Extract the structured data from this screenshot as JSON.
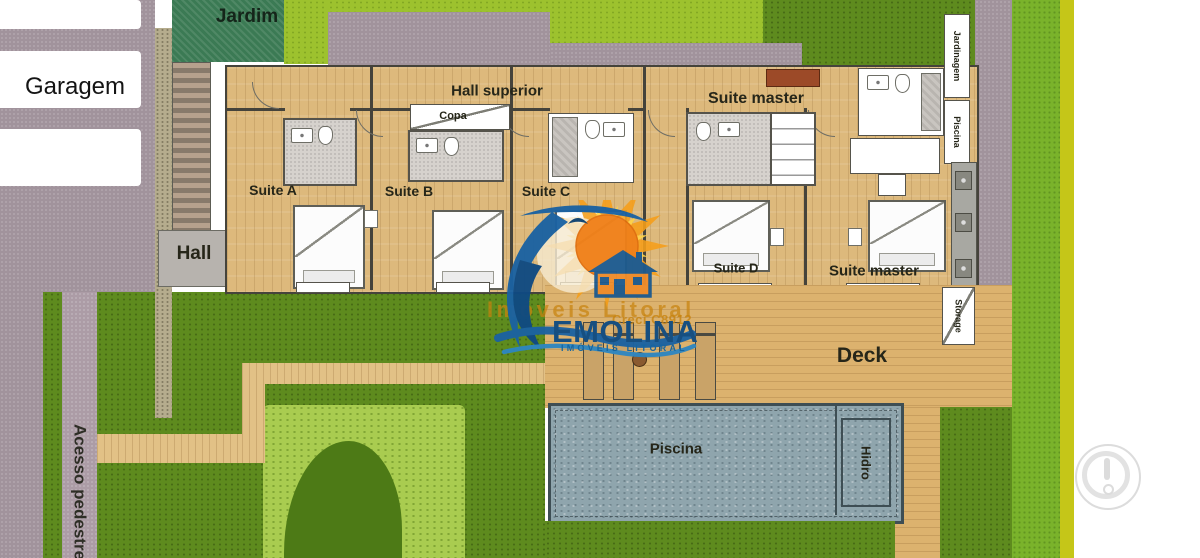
{
  "labels": {
    "garagem": "Garagem",
    "jardim": "Jardim",
    "hall_superior": "Hall superior",
    "copa": "Copa",
    "suite_a": "Suite A",
    "suite_b": "Suite B",
    "suite_c": "Suite C",
    "suite_d": "Suite D",
    "suite_master_top": "Suite master",
    "suite_master_bottom": "Suite master",
    "hall": "Hall",
    "deck": "Deck",
    "piscina_pool": "Piscina",
    "hidro": "Hidro",
    "storage": "Storage",
    "jardinagem": "Jardinagem",
    "piscina_side": "Piscina",
    "acesso_pedestre": "Acesso pedestre"
  },
  "watermark": {
    "orange_line": "Imóveis Litoral",
    "creci": "Creci C8912",
    "brand": "EMOLINA",
    "tagline": "IMÓVEIS LITORAL"
  },
  "colors": {
    "grass_dark": "#5e8b1e",
    "grass_light": "#a9cc50",
    "grass_lime": "#9dc22e",
    "grass_bright": "#7ab32b",
    "garden_teal": "#3b7a54",
    "paving_mauve": "#a1939c",
    "wood_floor": "#ddb97c",
    "pool_water": "#8fa5ad",
    "logo_blue": "#1b62a2",
    "logo_orange": "#f59e1a",
    "brand_blue": "#174f80",
    "watermark_orange": "#c8830f"
  }
}
